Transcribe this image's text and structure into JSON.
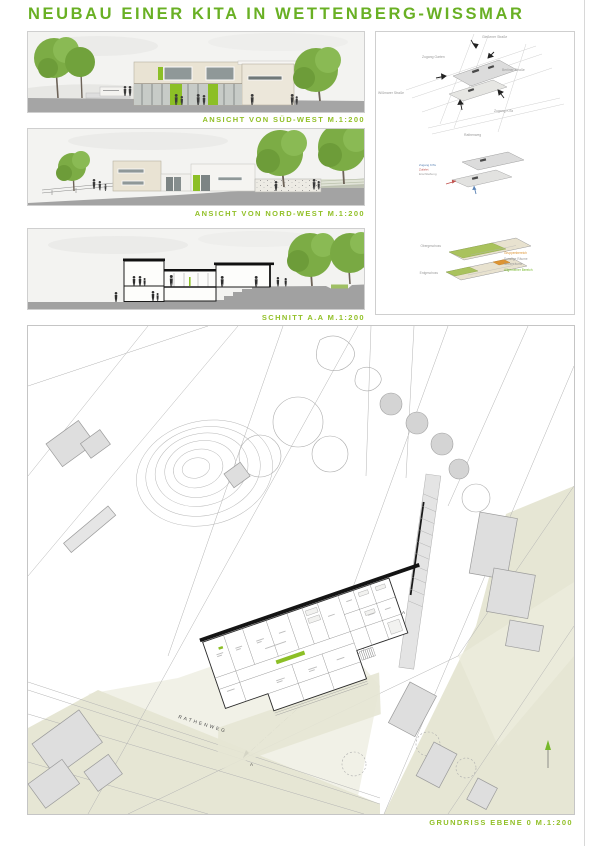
{
  "title": "NEUBAU EINER KITA IN WETTENBERG-WISSMAR",
  "colors": {
    "title_green": "#69b024",
    "label_green": "#92c028",
    "lime_accent": "#8cbf26",
    "facade_beige": "#e9e3d3",
    "site_olive": "#e6e6d4",
    "street_gray": "#a5a5a5"
  },
  "labels": {
    "elevation_sw": "ANSICHT VON SÜD-WEST M.1:200",
    "elevation_nw": "ANSICHT VON NORD-WEST M.1:200",
    "section": "SCHNITT A.A M.1:200",
    "site_plan": "GRUNDRISS EBENE 0 M.1:200",
    "street": "RATHENWEG",
    "section_marker": "A"
  },
  "diagram_top": {
    "street_top": "Gießener Straße",
    "street_right": "Berliner Straße",
    "street_left": "Wißmarer Straße",
    "street_bottom": "Rathenweg",
    "entry_garden": "Zugang Garten",
    "entry_kita": "Zugang KiTa"
  },
  "diagram_middle": {
    "label_blue": "Zugang KiTa",
    "label_red": "Zufahrt",
    "label_gray": "Erschließung",
    "blue": "#5b83b5",
    "red": "#c0504d",
    "gray": "#9a9a9a"
  },
  "diagram_bottom": {
    "upper_floor": "Obergeschoss",
    "ground_floor": "Erdgeschoss",
    "legend": [
      {
        "text": "Gruppenbereich",
        "color": "#dd9433"
      },
      {
        "text": "Sonstige Räume",
        "color": "#9a9a9a"
      },
      {
        "text": "Nebenräume",
        "color": "#9a9a9a"
      },
      {
        "text": "Allgemeiner Bereich",
        "color": "#76b82a"
      }
    ]
  }
}
